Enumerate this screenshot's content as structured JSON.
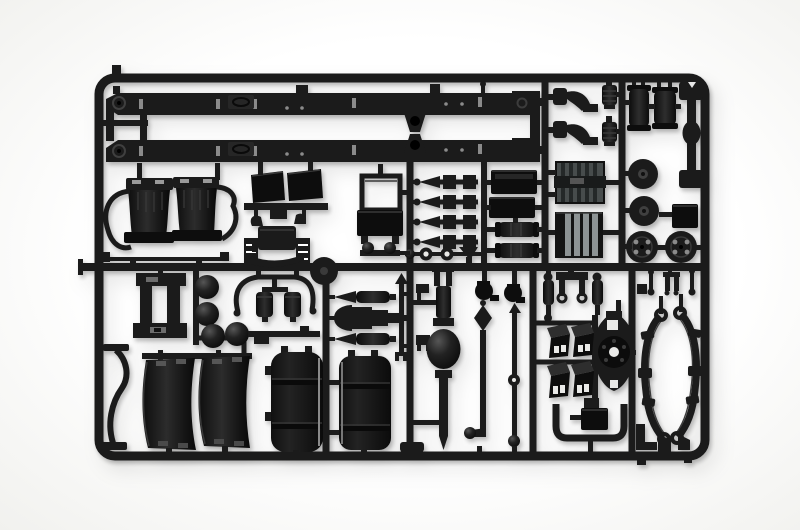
{
  "meta": {
    "description": "Photograph of a black injection-moulded plastic model-kit sprue (parts tree) for a truck chassis kit, lying on a plain white background",
    "subject": "model kit sprue with truck chassis parts"
  },
  "colors": {
    "background": "#ffffff",
    "background_edge": "#f1f1ee",
    "plastic": "#1b1b1b",
    "plastic_deep": "#0d0d0d",
    "plastic_sheen": "#3a3a3a",
    "detail_light": "#8b8b8b",
    "rib_gray": "#8d9394",
    "panel_gray": "#474c4c",
    "shadow": "rgba(0,0,0,0.25)"
  },
  "parts": [
    "sprue frame",
    "chassis rail upper",
    "chassis rail lower",
    "rail tee runner",
    "engine mount x2",
    "ribbed canister x2",
    "air tank x2",
    "equalizer beam",
    "pulley disc x2",
    "hub cap box",
    "flanged wheel x2",
    "ribbed panel upper",
    "ribbed panel lower",
    "battery box x2",
    "air reservoir x2",
    "torque rod x4",
    "washer chain",
    "radiator frame",
    "towing knobs",
    "mudflap panel pair",
    "cab suspension with coils",
    "double fender",
    "crossmember bracket",
    "air spring sphere x3",
    "intake arch with filter canisters",
    "junction disc",
    "ball linkage rod",
    "brake chamber x2",
    "gearbox cone",
    "arrow rod",
    "clamp x2",
    "u-joint yoke x2",
    "rear axle with differential",
    "drag link",
    "track rod",
    "shock absorber x2",
    "clevis bracket",
    "step bracket x4",
    "hub carrier",
    "storage box",
    "exhaust u-pipe",
    "hanger pins and fork",
    "leaf spring x2",
    "corner bracket",
    "spring foot x2",
    "exhaust hook",
    "thin rod",
    "fender half x2",
    "fuel tank half x2"
  ]
}
